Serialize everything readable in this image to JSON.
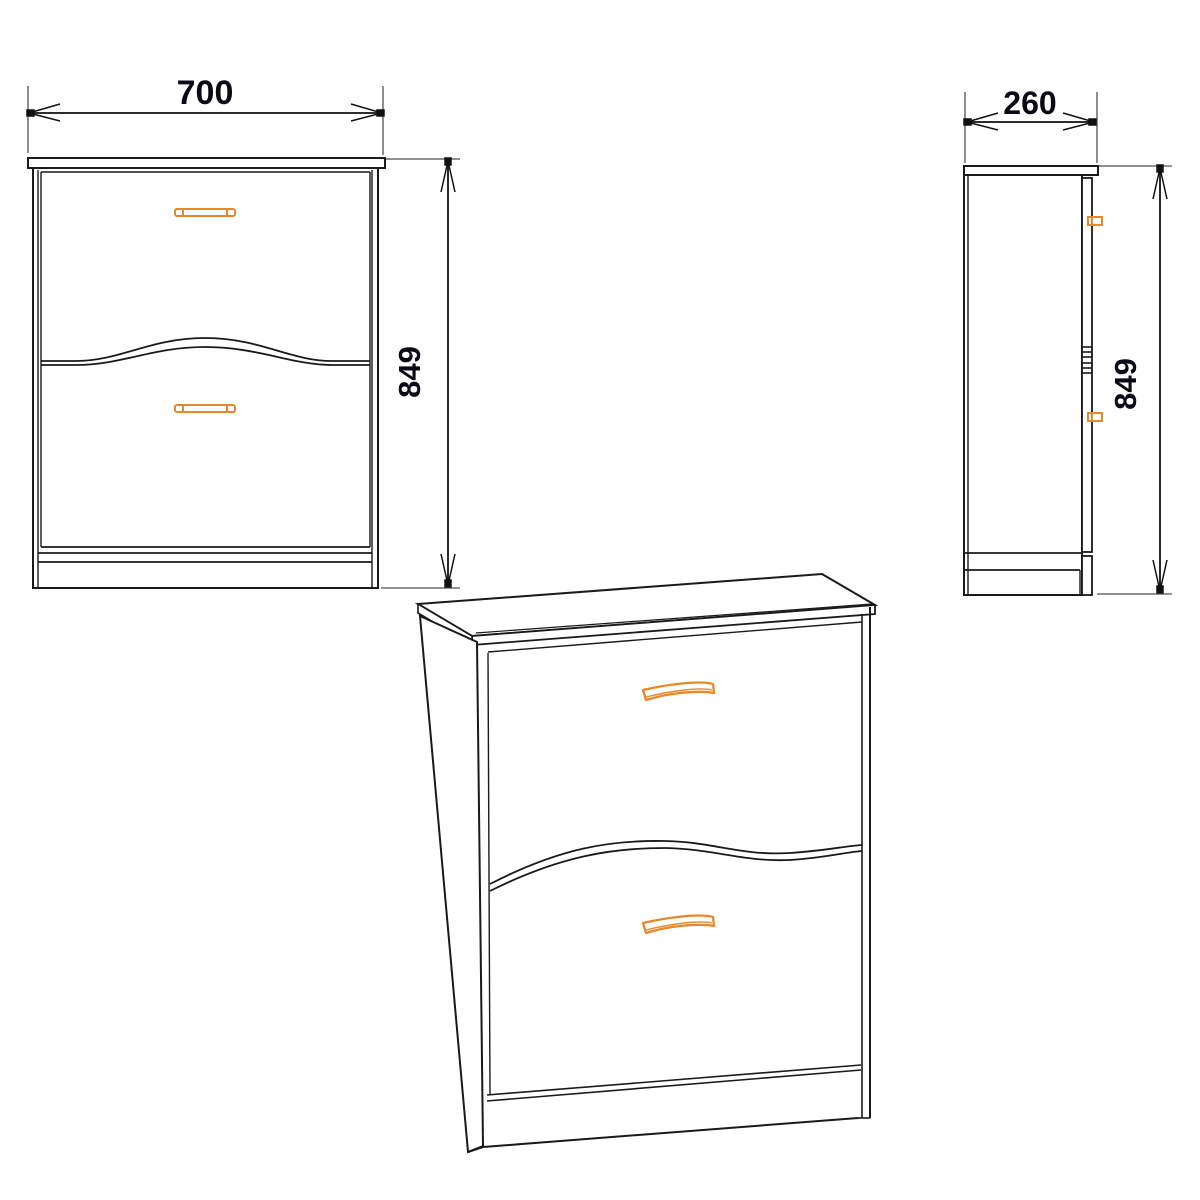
{
  "diagram": {
    "front_view": {
      "width_label": "700",
      "height_label": "849"
    },
    "side_view": {
      "depth_label": "260",
      "height_label": "849"
    },
    "colors": {
      "outline": "#1a1a1a",
      "extension_line": "#828282",
      "handle_accent": "#e8882a",
      "dimension_text": "#0a0a14"
    }
  }
}
